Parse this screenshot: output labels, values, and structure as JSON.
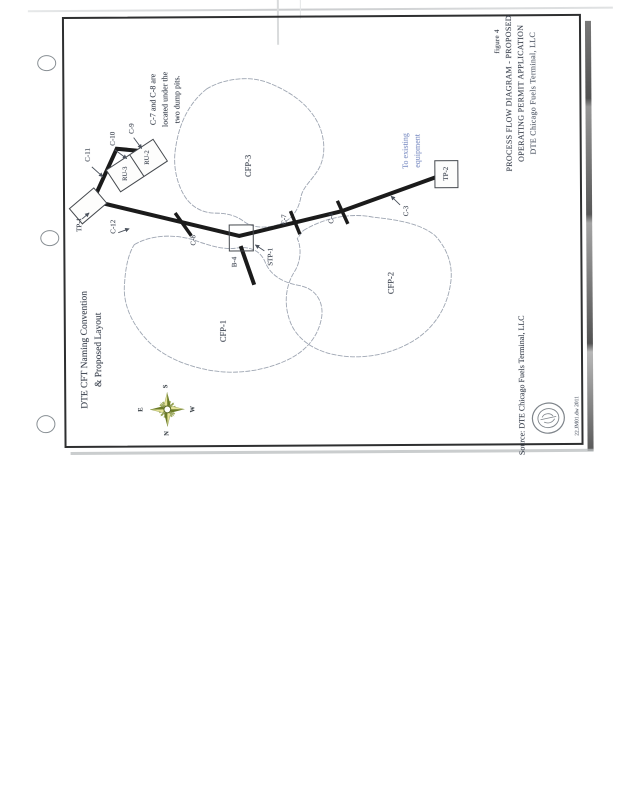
{
  "doc": {
    "figure_label": "figure 4",
    "title": {
      "line1": "PROCESS FLOW DIAGRAM - PROPOSED",
      "line2": "OPERATING PERMIT APPLICATION",
      "line3": "DTE Chicago Fuels Terminal, LLC"
    },
    "note": {
      "line1": "C-7 and C-8 are",
      "line2": "located under the",
      "line3": "two dump pits."
    },
    "annotation": {
      "line1": "To existing",
      "line2": "equipment"
    },
    "legend": {
      "line1": "DTE CFT Naming Convention",
      "line2": "& Proposed Layout"
    },
    "source": "Source: DTE Chicago Fuels Terminal, LLC",
    "margin_note": "22.JM01.dw 2011"
  },
  "labels": {
    "tp1": "TP-1",
    "tp2": "TP-2",
    "c3": "C-3",
    "c4": "C-4",
    "c7": "C-7",
    "c8": "C-8",
    "c9": "C-9",
    "c10": "C-10",
    "c11": "C-11",
    "c12": "C-12",
    "b4": "B-4",
    "stp1": "STP-1",
    "ru2": "RU-2",
    "ru3": "RU-3",
    "cfp1": "CFP-1",
    "cfp2": "CFP-2",
    "cfp3": "CFP-3"
  },
  "compass": {
    "top": "S",
    "right": "W",
    "bottom": "N",
    "left": "E"
  },
  "colors": {
    "ink": "#2e3440",
    "annotation_blue": "#8293c6",
    "compass_green": "#76842e",
    "compass_yellow": "#e6e39a",
    "paper": "#ffffff"
  }
}
